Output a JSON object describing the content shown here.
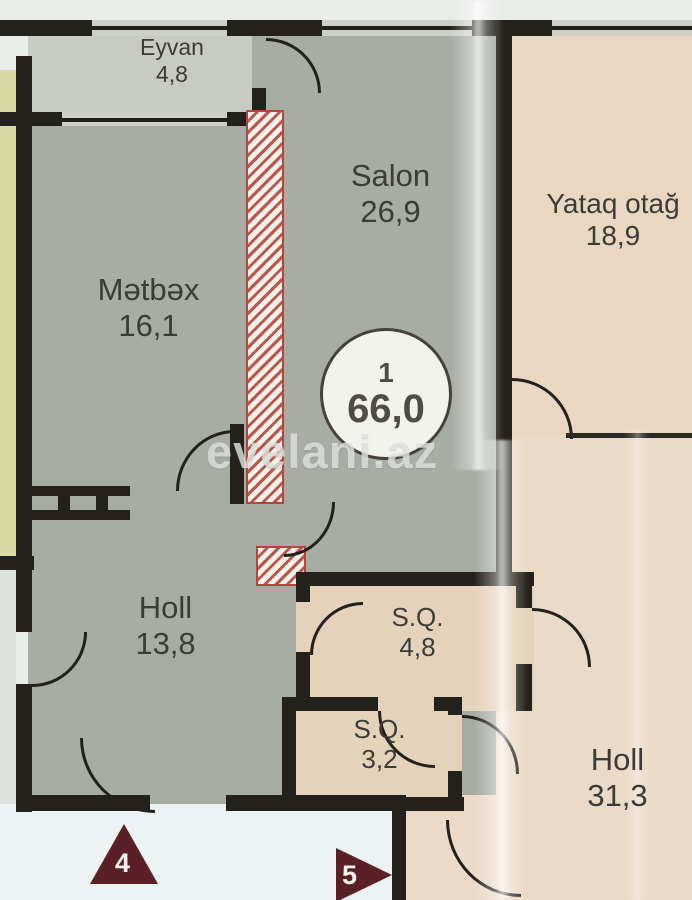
{
  "watermark": "evelani.az",
  "unit_badge": {
    "number": "1",
    "total_area": "66,0"
  },
  "rooms": [
    {
      "id": "eyvan",
      "name": "Eyvan",
      "area": "4,8"
    },
    {
      "id": "salon",
      "name": "Salon",
      "area": "26,9"
    },
    {
      "id": "metbex",
      "name": "Mətbəx",
      "area": "16,1"
    },
    {
      "id": "yataq",
      "name": "Yataq otağ",
      "area": "18,9"
    },
    {
      "id": "holl1",
      "name": "Holl",
      "area": "13,8"
    },
    {
      "id": "sq1",
      "name": "S.Q.",
      "area": "4,8"
    },
    {
      "id": "sq2",
      "name": "S.Q.",
      "area": "3,2"
    },
    {
      "id": "holl2",
      "name": "Holl",
      "area": "31,3"
    }
  ],
  "markers": [
    {
      "label": "4"
    },
    {
      "label": "5"
    }
  ],
  "colors": {
    "wall": "#23211b",
    "room_gray": "#a7aca4",
    "room_gray_light": "#c8cbc4",
    "room_peach": "#e9d7c1",
    "room_yellow": "#d8daa2",
    "shaft_red": "#b5453a",
    "marker_maroon": "#5a2026",
    "text": "#3c3c36"
  }
}
